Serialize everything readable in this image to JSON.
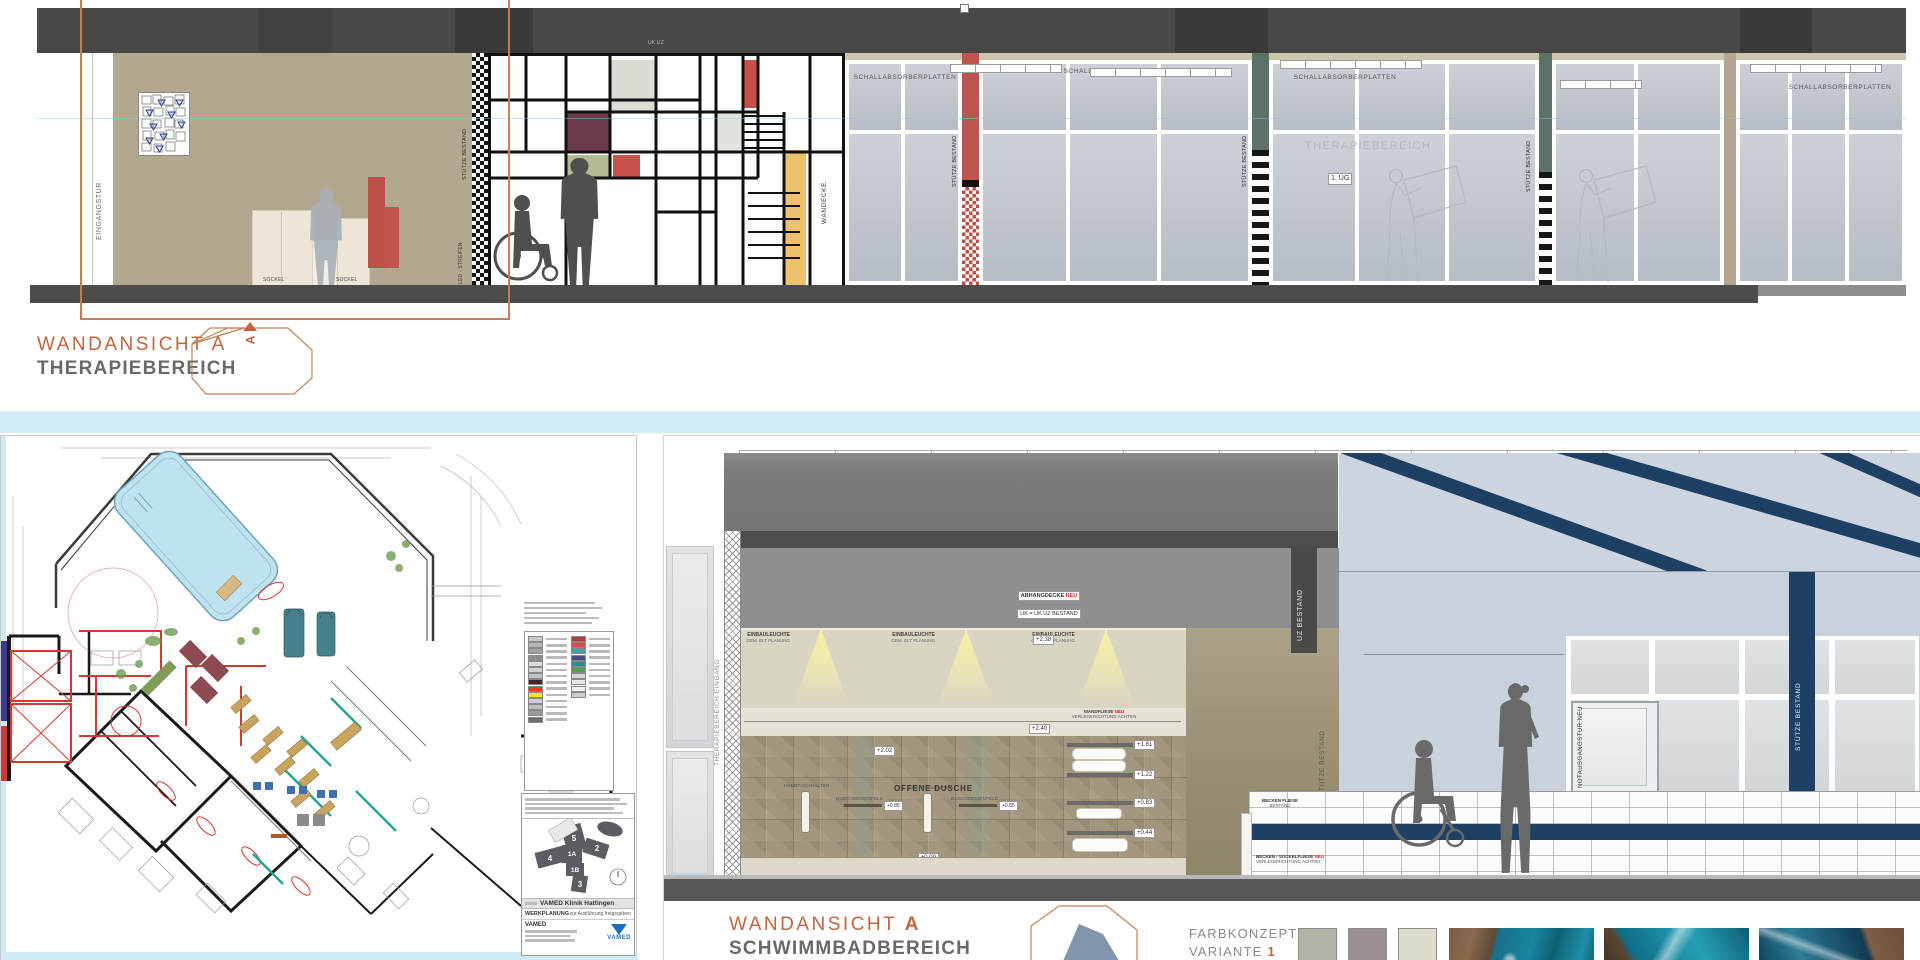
{
  "colors": {
    "accent_orange": "#c06540",
    "navy": "#1d4064",
    "pool_blue": "#bfe2ef",
    "divider_blue": "#d3edf7",
    "red": "#bf4f48",
    "green_column": "#5d7266",
    "beige_column": "#b3a58f",
    "yellow": "#edc16d",
    "maroon": "#6b3c49",
    "olive": "#b5ba90",
    "vamed_blue": "#1d6fb8"
  },
  "top_elevation": {
    "title": "WANDANSICHT A",
    "subtitle": "THERAPIEBEREICH",
    "section_marker": "A",
    "labels": {
      "eingangstuer": "EINGANGSTÜR",
      "sockel": "SOCKEL",
      "led_streifen": "LED - STREIFEN",
      "stuetze_bestand": "STÜTZE BESTAND",
      "uk_uz": "UK UZ",
      "wandecke": "WANDECKE",
      "schallabsorberplatten": "SCHALLABSORBERPLATTEN",
      "therapiebereich": "THERAPIEBEREICH",
      "geschoss": "1. UG"
    }
  },
  "floor_plan": {
    "titleblock": {
      "project": "VAMED Klinik Hattingen",
      "phase": "WERKPLANUNG",
      "release": "zur Ausführung freigegeben",
      "company": "VAMED",
      "logo": "VAMED",
      "wings": {
        "w5": "5",
        "w4": "4",
        "w1a": "1A",
        "w1b": "1B",
        "w2": "2",
        "w3": "3"
      }
    },
    "legend_left": [
      "#c9c9c9",
      "#b5b5b5",
      "#a2a2a2",
      "#8f8f8f",
      "#dddddd",
      "#d0d0d0",
      "#c2c2c2",
      "#2f2f2f",
      "#e23b30",
      "#f4e33b",
      "#cfcfcf",
      "#bdbdbd",
      "#9a9a9a",
      "#6e6e6e"
    ],
    "legend_right": [
      "#b23b3b",
      "#d94f45",
      "#3fa0a8",
      "#4a4a8f",
      "#2e8f8f",
      "#4f9f4f",
      "#d7d7d7",
      "#e8e8e8",
      "#f0f0f0",
      "#cccccc"
    ]
  },
  "bottom_elevation": {
    "title_word": "WANDANSICHT",
    "title_letter": "A",
    "subtitle": "SCHWIMMBADBEREICH",
    "labels": {
      "eingang": "THERAPIEBEREICH EINGANG",
      "abhangdecke": "ABHANGDECKE",
      "abhangdecke_neu": "NEU",
      "abhangdecke_sub": "UK = UK UZ BESTAND",
      "einbauleuchte": "EINBAULEUCHTE",
      "einbauleuchte_sub": "GEM. ELT PLANUNG",
      "uz_bestand": "UZ BESTAND",
      "stuetze_bestand": "STÜTZE BESTAND",
      "offene_dusche": "OFFENE DUSCHE",
      "handtuchhalter": "HANDTUCHHALTER",
      "duschbedienfeld": "DUSCHBEDIENFELD",
      "wandfliese": "WANDFLIESE",
      "wandfliese_neu": "NEU",
      "verlegerichtung": "VERLEGERICHTUNG ACHTEN",
      "duschrinne": "DUSCHRINNE SEITWAND",
      "bodenablauf": "BODENABLAUF NEU",
      "bodenablauf_sub": "S. DETAIL",
      "becken_fliese": "BECKEN FLIESE",
      "becken_fliese_sub": "BESTAND",
      "becken_sockel": "BECKEN / SOCKELFLIESE",
      "becken_sockel_neu": "NEU",
      "becken_sockel_sub": "VERLEGERICHTUNG ACHTEN",
      "notausgang": "NOTAUSGANGSTÜR",
      "notausgang_neu": "NEU"
    },
    "levels": {
      "l238": "+2.38",
      "l240": "+2.40",
      "l202": "+2.02",
      "l161": "+1.61",
      "l122": "+1.22",
      "l083": "+0.83",
      "l044": "+0.44",
      "l000": "±0.00",
      "l085": "+0.85"
    },
    "farbkonzept": {
      "line1": "FARBKONZEPT",
      "line2": "VARIANTE",
      "number": "1",
      "swatches": [
        "#b2b2a6",
        "#9c9097",
        "#dedccd"
      ]
    }
  }
}
